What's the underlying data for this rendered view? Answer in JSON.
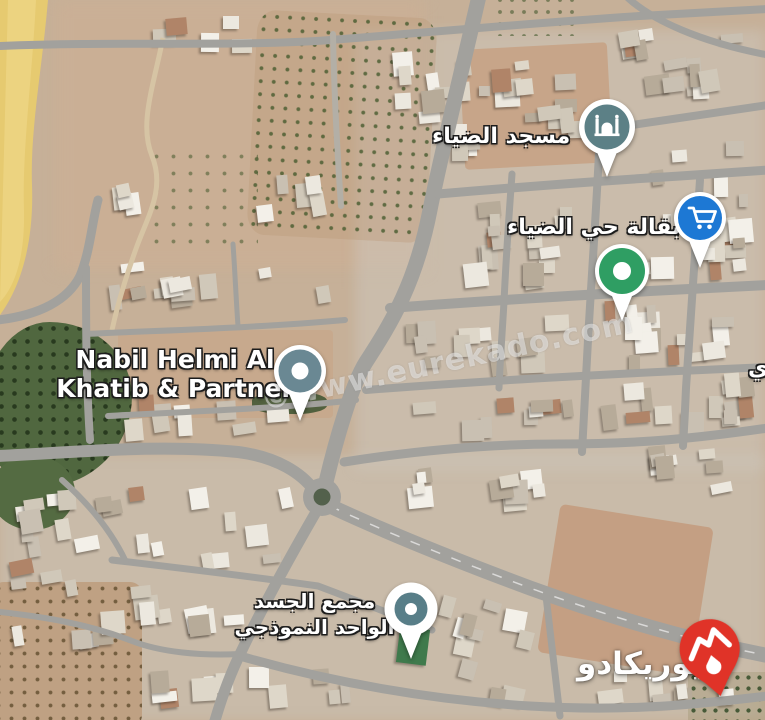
{
  "map_labels": {
    "mosque": "مسجد الضياء",
    "grocery": "بقالة حي الضياء",
    "office_line1": "Nabil Helmi Al",
    "office_line2": "Khatib & Partner",
    "complex_line1": "مجمع الجسد",
    "complex_line2": "الواحد النموذجي",
    "edge_fragment": "ي"
  },
  "watermark": {
    "text": "©www.eurekado.com"
  },
  "branding": {
    "name": "يوريكادو",
    "logo_color": "#e03328"
  },
  "markers": {
    "mosque_pin": {
      "icon": "mosque-icon",
      "color": "#5c8086"
    },
    "grocery_pin": {
      "icon": "shopping-cart-icon",
      "color": "#1d78d4"
    },
    "location_pin_green": {
      "icon": "dot-marker-icon",
      "color": "#2f9e63"
    },
    "office_pin": {
      "icon": "dot-marker-icon",
      "color": "#6a8893"
    },
    "complex_pin": {
      "icon": "dot-marker-icon",
      "color": "#587e88"
    }
  },
  "colors": {
    "terrain": "#c6b098",
    "road": "#a2a19d",
    "sand": "#e6ca70",
    "forest": "#50673f",
    "urban_wash": "#cec8be",
    "lot_brown": "#c39c7e"
  }
}
